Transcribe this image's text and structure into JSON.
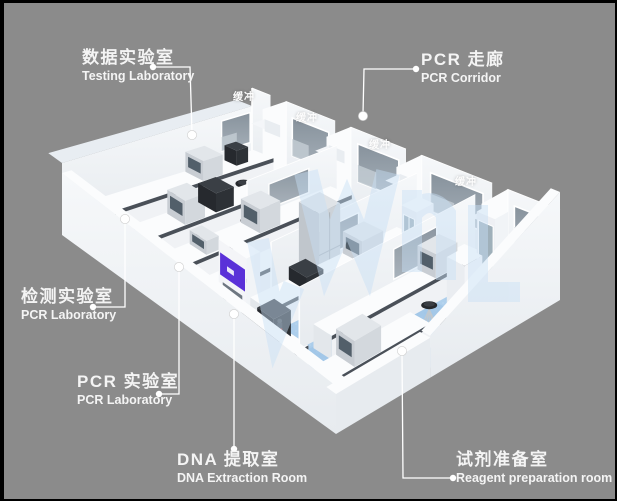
{
  "page": {
    "background": "#8b8b8b",
    "frame": "#000000"
  },
  "colors": {
    "floor": "#a5c9e9",
    "floorLight": "#bad7f0",
    "floorDeep": "#9cc3e6",
    "walkway": "#cde2f4",
    "wall": "#f1f4f7",
    "wallBright": "#fbfcfd",
    "wallShade": "#e7ebef",
    "wallTop": "#e8edf2",
    "glass": "#939ea8",
    "glassDark": "#87929c",
    "glassLight": "#c2cbd2",
    "benchTop": "#fbfcfd",
    "benchFront": "#f0f2f5",
    "benchSide": "#e3e7eb",
    "benchEdge": "#4a5058",
    "equipTop": "#e2e6ea",
    "equipFront": "#d3d8dd",
    "equipSide": "#c8cdd3",
    "screen": "#525f6a",
    "darkTop": "#3a3f45",
    "darkFront": "#2d3136",
    "darkSide": "#26292e",
    "fridgeTop": "#dfe3e7",
    "fridgeFront": "#ccd2d8",
    "fridgeSide": "#c0c6cc",
    "accentPurple": "#5a31d8",
    "purpleSlot": "#e9e6f8",
    "hoodOpening": "#97a1ab",
    "stoolSeat": "#26292d",
    "stoolSeatHi": "#3a3e44",
    "metal": "#c2c8cd",
    "watermark": "#c8e0f6",
    "leader": "#ffffff",
    "personBody": "#40464d",
    "personAccent": "#c23b34"
  },
  "labels": [
    {
      "id": "testing-laboratory",
      "zh": "数据实验室",
      "en": "Testing Laboratory"
    },
    {
      "id": "pcr-corridor",
      "zh": "PCR 走廊",
      "en": "PCR Corridor"
    },
    {
      "id": "detection-laboratory",
      "zh": "检测实验室",
      "en": "PCR Laboratory"
    },
    {
      "id": "pcr-laboratory",
      "zh": "PCR 实验室",
      "en": "PCR Laboratory"
    },
    {
      "id": "dna-extraction-room",
      "zh": "DNA 提取室",
      "en": "DNA Extraction Room"
    },
    {
      "id": "reagent-preparation-room",
      "zh": "试剂准备室",
      "en": "Reagent preparation room"
    }
  ],
  "buffer": {
    "text": "缓冲"
  }
}
